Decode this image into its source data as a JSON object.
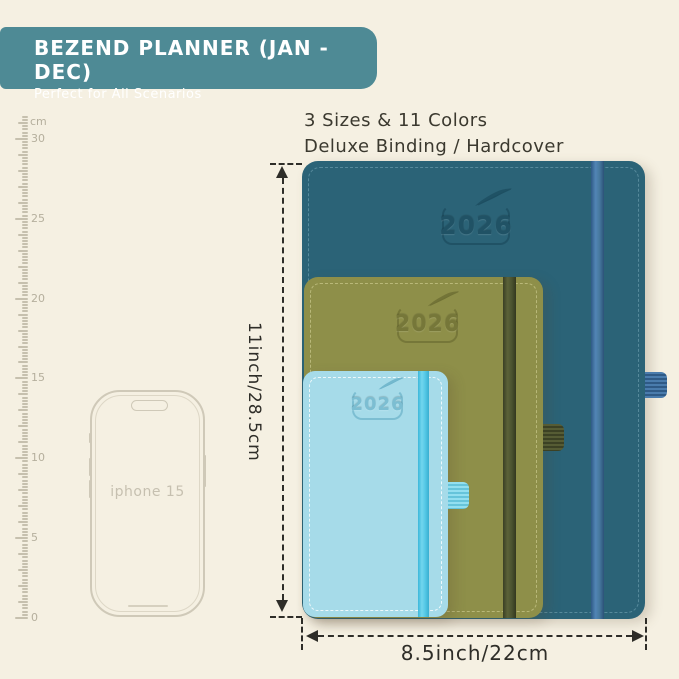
{
  "colors": {
    "background": "#f5f0e2",
    "banner_bg": "#4e8a95",
    "banner_text": "#ffffff",
    "headline_text": "#3b392f",
    "ruler": "#c6c0ae",
    "phone_outline": "#cfc9b8",
    "dimension": "#2e2d28"
  },
  "banner": {
    "title": "BEZEND PLANNER (JAN - DEC)",
    "subtitle": "Perfect for All Scenarios"
  },
  "headline": {
    "line1": "3 Sizes & 11 Colors",
    "line2": "Deluxe Binding / Hardcover"
  },
  "ruler": {
    "unit": "cm",
    "labels": [
      30,
      25,
      20,
      15,
      10,
      5,
      0
    ]
  },
  "phone": {
    "label": "iphone 15"
  },
  "planners": [
    {
      "id": "large",
      "year": "2026",
      "cover": "#2b6377",
      "elastic": "#4478a9",
      "deboss": "#1d4d60"
    },
    {
      "id": "medium",
      "year": "2026",
      "cover": "#8e8f49",
      "elastic": "#4d5433",
      "deboss": "#6f7034"
    },
    {
      "id": "small",
      "year": "2026",
      "cover": "#a6dbe9",
      "elastic": "#55c8e6",
      "deboss": "#6fb5cb"
    }
  ],
  "dimensions": {
    "height_label": "11inch/28.5cm",
    "width_label": "8.5inch/22cm"
  }
}
